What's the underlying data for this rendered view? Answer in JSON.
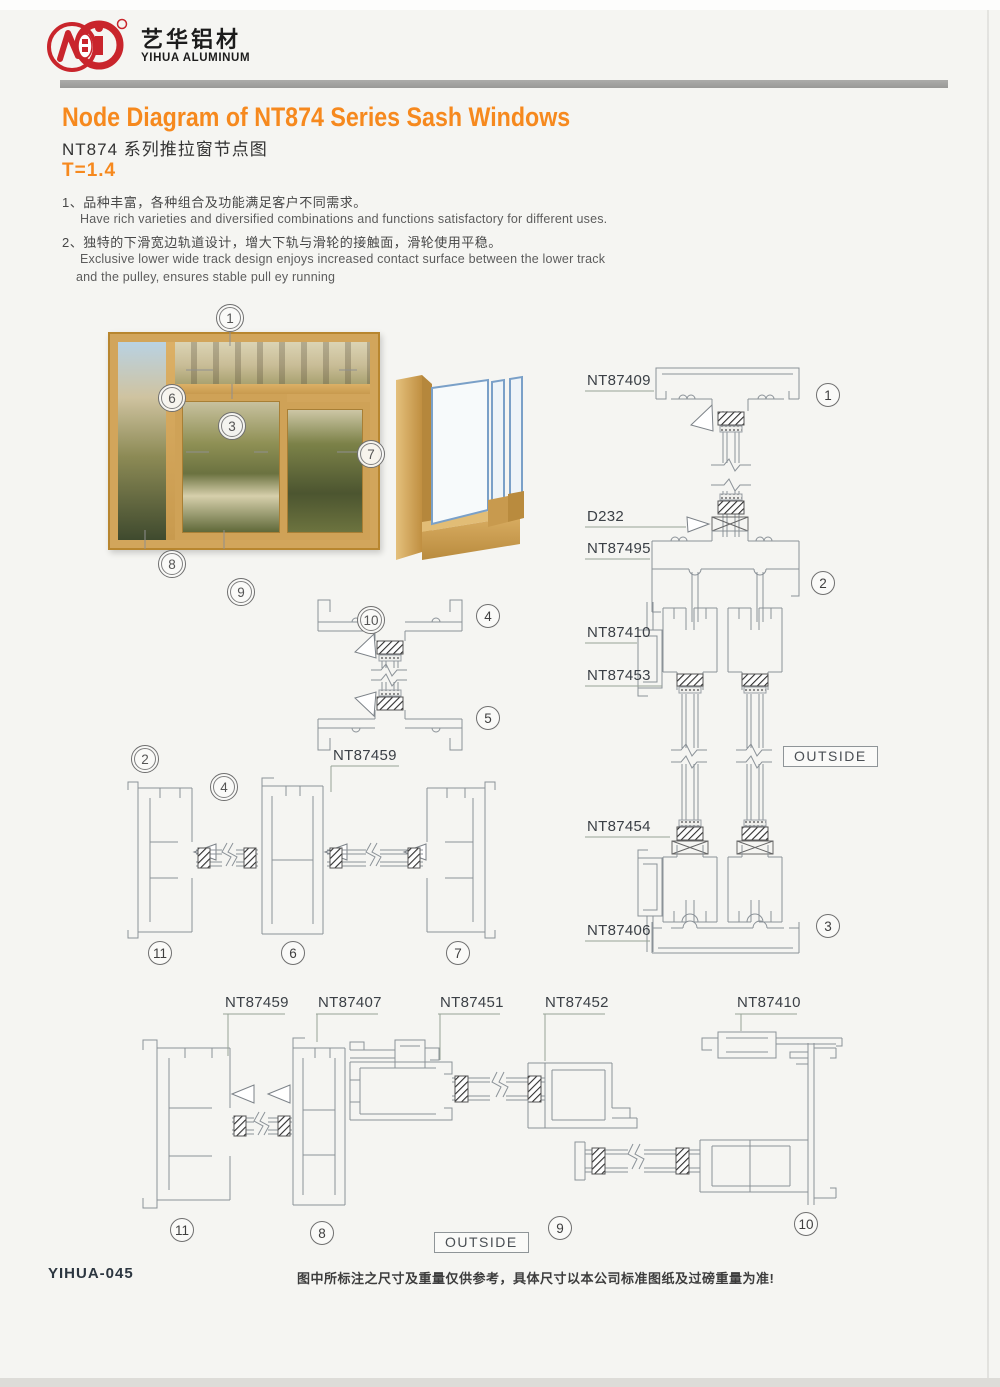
{
  "brand": {
    "cn": "艺华铝材",
    "en": "YIHUA ALUMINUM"
  },
  "header": {
    "title_en": "Node Diagram of NT874 Series Sash Windows",
    "title_cn": "NT874 系列推拉窗节点图",
    "thickness": "T=1.4",
    "accent_color": "#f6891e"
  },
  "features": {
    "item1_cn": "1、品种丰富，各种组合及功能满足客户不同需求。",
    "item1_en": "Have rich varieties and diversified combinations and functions satisfactory for different uses.",
    "item2_cn": "2、独特的下滑宽边轨道设计，增大下轨与滑轮的接触面，滑轮使用平稳。",
    "item2_en_line1": "Exclusive lower wide track design enjoys increased contact surface between the lower track",
    "item2_en_line2": "and the pulley, ensures stable pull ey running"
  },
  "labels": {
    "nt87409": "NT87409",
    "d232": "D232",
    "nt87495": "NT87495",
    "nt87410": "NT87410",
    "nt87453": "NT87453",
    "nt87454": "NT87454",
    "nt87406": "NT87406",
    "nt87459": "NT87459",
    "nt87407": "NT87407",
    "nt87451": "NT87451",
    "nt87452": "NT87452",
    "outside": "OUTSIDE"
  },
  "callouts": {
    "n1": "1",
    "n2": "2",
    "n3": "3",
    "n4": "4",
    "n5": "5",
    "n6": "6",
    "n7": "7",
    "n8": "8",
    "n9": "9",
    "n10": "10",
    "n11": "11"
  },
  "footer": {
    "code": "YIHUA-045",
    "disclaimer": "图中所标注之尺寸及重量仅供参考，具体尺寸以本公司标准图纸及过磅重量为准!"
  }
}
